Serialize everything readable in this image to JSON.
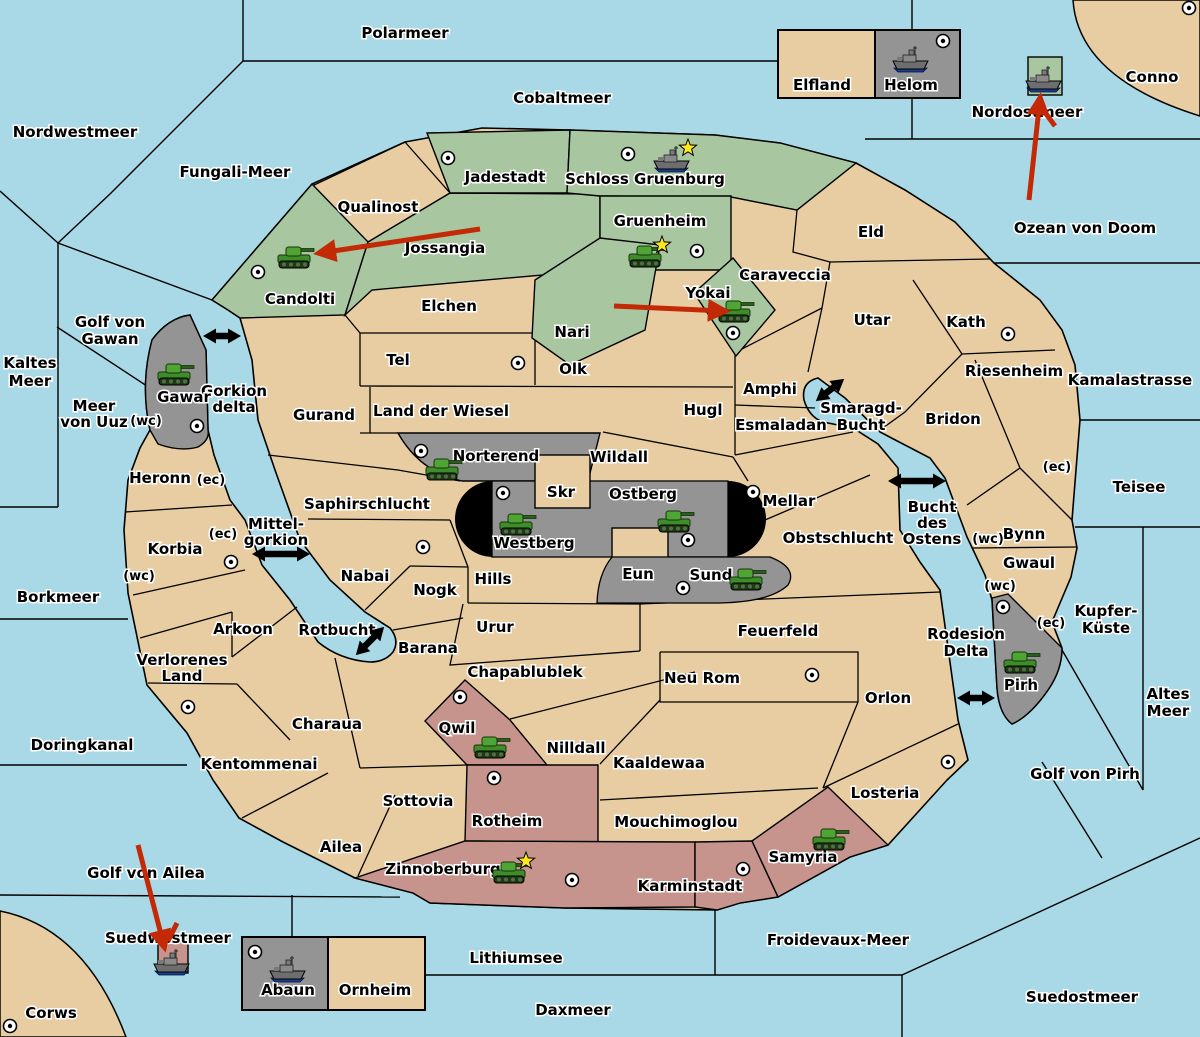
{
  "colors": {
    "sea": "#A9D9E6",
    "land": "#E9CDA2",
    "green": "#A8C6A0",
    "gray": "#949494",
    "red": "#C6948D",
    "black_zone": "#000000",
    "arrow_red": "#C32905",
    "border": "#000000",
    "star": "#FFE81E"
  },
  "ownership": {
    "green_regions": [
      "Candolti",
      "Jossangia",
      "Jadestadt",
      "Schloss Gruenburg",
      "Gruenheim",
      "Nari",
      "Yokai"
    ],
    "gray_regions": [
      "Gawar",
      "Norterend",
      "Westberg",
      "Ostberg",
      "Sund",
      "Pirh",
      "Helom",
      "Abaun"
    ],
    "red_regions": [
      "Qwil",
      "Rotheim",
      "Zinnoberburg",
      "Karminstadt",
      "Samyria"
    ]
  },
  "labels": [
    {
      "id": "polarmeer",
      "k": "sea",
      "x": 405,
      "y": 38,
      "t": "Polarmeer"
    },
    {
      "id": "cobaltmeer",
      "k": "sea",
      "x": 562,
      "y": 103,
      "t": "Cobaltmeer"
    },
    {
      "id": "nordwestmeer",
      "k": "sea",
      "x": 75,
      "y": 137,
      "t": "Nordwestmeer"
    },
    {
      "id": "fungali-meer",
      "k": "sea",
      "x": 235,
      "y": 177,
      "t": "Fungali-Meer"
    },
    {
      "id": "kaltes-meer",
      "k": "sea",
      "x": 30,
      "y": 368,
      "lines": [
        "Kaltes",
        "Meer"
      ],
      "lh": 18
    },
    {
      "id": "golf-von-gawan",
      "k": "sea",
      "x": 110,
      "y": 327,
      "lines": [
        "Golf von",
        "Gawan"
      ],
      "lh": 17
    },
    {
      "id": "meer-von-uuz",
      "k": "sea",
      "x": 94,
      "y": 411,
      "lines": [
        "Meer",
        "von Uuz"
      ],
      "lh": 16
    },
    {
      "id": "gorkion-delta",
      "k": "sea",
      "x": 234,
      "y": 396,
      "lines": [
        "Gorkion",
        "delta"
      ],
      "lh": 16
    },
    {
      "id": "mittel-gorkion",
      "k": "sea",
      "x": 276,
      "y": 529,
      "lines": [
        "Mittel-",
        "gorkion"
      ],
      "lh": 16
    },
    {
      "id": "borkmeer",
      "k": "sea",
      "x": 58,
      "y": 602,
      "t": "Borkmeer"
    },
    {
      "id": "doringkanal",
      "k": "sea",
      "x": 82,
      "y": 750,
      "t": "Doringkanal"
    },
    {
      "id": "rotbucht",
      "k": "sea",
      "x": 337,
      "y": 635,
      "t": "Rotbucht"
    },
    {
      "id": "smaragd-bucht",
      "k": "sea",
      "x": 861,
      "y": 413,
      "lines": [
        "Smaragd-",
        "Bucht"
      ],
      "lh": 17
    },
    {
      "id": "bucht-des-ostens",
      "k": "sea",
      "x": 932,
      "y": 512,
      "lines": [
        "Bucht",
        "des",
        "Ostens"
      ],
      "lh": 16
    },
    {
      "id": "rodesion-delta",
      "k": "sea",
      "x": 966,
      "y": 639,
      "lines": [
        "Rodesion",
        "Delta"
      ],
      "lh": 17
    },
    {
      "id": "golf-von-pirh",
      "k": "sea",
      "x": 1085,
      "y": 779,
      "t": "Golf von Pirh"
    },
    {
      "id": "altes-meer",
      "k": "sea",
      "x": 1168,
      "y": 699,
      "lines": [
        "Altes",
        "Meer"
      ],
      "lh": 17
    },
    {
      "id": "kupfer-kueste",
      "k": "sea",
      "x": 1106,
      "y": 616,
      "lines": [
        "Kupfer-",
        "Küste"
      ],
      "lh": 17
    },
    {
      "id": "teisee",
      "k": "sea",
      "x": 1139,
      "y": 492,
      "t": "Teisee"
    },
    {
      "id": "kamalastrasse",
      "k": "sea",
      "x": 1130,
      "y": 385,
      "t": "Kamalastrasse"
    },
    {
      "id": "ozean-von-doom",
      "k": "sea",
      "x": 1085,
      "y": 233,
      "t": "Ozean von Doom"
    },
    {
      "id": "conno",
      "k": "sea",
      "x": 1152,
      "y": 82,
      "t": "Conno"
    },
    {
      "id": "nordostmeer",
      "k": "sea",
      "x": 1027,
      "y": 117,
      "t": "Nordostmeer"
    },
    {
      "id": "froidevaux-meer",
      "k": "sea",
      "x": 838,
      "y": 945,
      "t": "Froidevaux-Meer"
    },
    {
      "id": "suedostmeer",
      "k": "sea",
      "x": 1082,
      "y": 1002,
      "t": "Suedostmeer"
    },
    {
      "id": "daxmeer",
      "k": "sea",
      "x": 573,
      "y": 1015,
      "t": "Daxmeer"
    },
    {
      "id": "lithiumsee",
      "k": "sea",
      "x": 516,
      "y": 963,
      "t": "Lithiumsee"
    },
    {
      "id": "suedwestmeer",
      "k": "sea",
      "x": 168,
      "y": 943,
      "t": "Suedwestmeer"
    },
    {
      "id": "golf-von-ailea",
      "k": "sea",
      "x": 146,
      "y": 878,
      "t": "Golf von Ailea"
    },
    {
      "id": "corws",
      "k": "sea",
      "x": 51,
      "y": 1018,
      "t": "Corws"
    },
    {
      "id": "qualinost",
      "k": "land",
      "x": 378,
      "y": 212,
      "t": "Qualinost"
    },
    {
      "id": "jadestadt",
      "k": "land",
      "x": 505,
      "y": 182,
      "t": "Jadestadt"
    },
    {
      "id": "schloss-gruenburg",
      "k": "land",
      "x": 645,
      "y": 184,
      "t": "Schloss Gruenburg"
    },
    {
      "id": "gruenheim",
      "k": "land",
      "x": 660,
      "y": 226,
      "t": "Gruenheim"
    },
    {
      "id": "jossangia",
      "k": "land",
      "x": 445,
      "y": 253,
      "t": "Jossangia"
    },
    {
      "id": "candolti",
      "k": "land",
      "x": 300,
      "y": 304,
      "t": "Candolti"
    },
    {
      "id": "nari",
      "k": "land",
      "x": 572,
      "y": 337,
      "t": "Nari"
    },
    {
      "id": "yokai",
      "k": "land",
      "x": 708,
      "y": 298,
      "t": "Yokai"
    },
    {
      "id": "elchen",
      "k": "land",
      "x": 449,
      "y": 311,
      "t": "Elchen"
    },
    {
      "id": "tel",
      "k": "land",
      "x": 398,
      "y": 365,
      "t": "Tel"
    },
    {
      "id": "olk",
      "k": "land",
      "x": 573,
      "y": 374,
      "t": "Olk"
    },
    {
      "id": "gurand",
      "k": "land",
      "x": 324,
      "y": 420,
      "t": "Gurand"
    },
    {
      "id": "land-der-wiesel",
      "k": "land",
      "x": 441,
      "y": 416,
      "t": "Land der Wiesel"
    },
    {
      "id": "hugl",
      "k": "land",
      "x": 703,
      "y": 415,
      "t": "Hugl"
    },
    {
      "id": "amphi",
      "k": "land",
      "x": 770,
      "y": 394,
      "t": "Amphi"
    },
    {
      "id": "esmaladan",
      "k": "land",
      "x": 781,
      "y": 430,
      "t": "Esmaladan"
    },
    {
      "id": "caraveccia",
      "k": "land",
      "x": 785,
      "y": 280,
      "t": "Caraveccia"
    },
    {
      "id": "eld",
      "k": "land",
      "x": 871,
      "y": 237,
      "t": "Eld"
    },
    {
      "id": "utar",
      "k": "land",
      "x": 872,
      "y": 325,
      "t": "Utar"
    },
    {
      "id": "kath",
      "k": "land",
      "x": 966,
      "y": 327,
      "t": "Kath"
    },
    {
      "id": "riesenheim",
      "k": "land",
      "x": 1014,
      "y": 376,
      "t": "Riesenheim"
    },
    {
      "id": "bridon",
      "k": "land",
      "x": 953,
      "y": 424,
      "t": "Bridon"
    },
    {
      "id": "bynn",
      "k": "land",
      "x": 1024,
      "y": 539,
      "t": "Bynn"
    },
    {
      "id": "gwaul",
      "k": "land",
      "x": 1029,
      "y": 568,
      "t": "Gwaul"
    },
    {
      "id": "wildall",
      "k": "land",
      "x": 619,
      "y": 462,
      "t": "Wildall"
    },
    {
      "id": "skr",
      "k": "land",
      "x": 561,
      "y": 497,
      "t": "Skr"
    },
    {
      "id": "eun",
      "k": "land",
      "x": 638,
      "y": 579,
      "t": "Eun"
    },
    {
      "id": "mellar",
      "k": "land",
      "x": 789,
      "y": 506,
      "t": "Mellar"
    },
    {
      "id": "obstschlucht",
      "k": "land",
      "x": 838,
      "y": 543,
      "t": "Obstschlucht"
    },
    {
      "id": "norterend",
      "k": "land",
      "x": 496,
      "y": 461,
      "t": "Norterend"
    },
    {
      "id": "westberg",
      "k": "land",
      "x": 534,
      "y": 548,
      "t": "Westberg"
    },
    {
      "id": "ostberg",
      "k": "land",
      "x": 643,
      "y": 499,
      "t": "Ostberg"
    },
    {
      "id": "sund",
      "k": "land",
      "x": 711,
      "y": 580,
      "t": "Sund"
    },
    {
      "id": "hills",
      "k": "land",
      "x": 493,
      "y": 584,
      "t": "Hills"
    },
    {
      "id": "urur",
      "k": "land",
      "x": 495,
      "y": 632,
      "t": "Urur"
    },
    {
      "id": "feuerfeld",
      "k": "land",
      "x": 778,
      "y": 636,
      "t": "Feuerfeld"
    },
    {
      "id": "saphirschlucht",
      "k": "land",
      "x": 367,
      "y": 509,
      "t": "Saphirschlucht"
    },
    {
      "id": "nabai",
      "k": "land",
      "x": 365,
      "y": 581,
      "t": "Nabai"
    },
    {
      "id": "nogk",
      "k": "land",
      "x": 435,
      "y": 595,
      "t": "Nogk"
    },
    {
      "id": "barana",
      "k": "land",
      "x": 428,
      "y": 653,
      "t": "Barana"
    },
    {
      "id": "chapablublek",
      "k": "land",
      "x": 525,
      "y": 677,
      "t": "Chapablublek"
    },
    {
      "id": "neu-rom",
      "k": "land",
      "x": 702,
      "y": 683,
      "t": "Neu Rom"
    },
    {
      "id": "kaaldewaa",
      "k": "land",
      "x": 659,
      "y": 768,
      "t": "Kaaldewaa"
    },
    {
      "id": "nilldall",
      "k": "land",
      "x": 576,
      "y": 753,
      "t": "Nilldall"
    },
    {
      "id": "heronn",
      "k": "land",
      "x": 160,
      "y": 483,
      "t": "Heronn"
    },
    {
      "id": "korbia",
      "k": "land",
      "x": 175,
      "y": 554,
      "t": "Korbia"
    },
    {
      "id": "arkoon",
      "k": "land",
      "x": 243,
      "y": 634,
      "t": "Arkoon"
    },
    {
      "id": "verlorenes-land",
      "k": "land",
      "x": 182,
      "y": 665,
      "lines": [
        "Verlorenes",
        "Land"
      ],
      "lh": 16
    },
    {
      "id": "kentommenai",
      "k": "land",
      "x": 259,
      "y": 769,
      "t": "Kentommenai"
    },
    {
      "id": "charaua",
      "k": "land",
      "x": 327,
      "y": 729,
      "t": "Charaua"
    },
    {
      "id": "sottovia",
      "k": "land",
      "x": 418,
      "y": 806,
      "t": "Sottovia"
    },
    {
      "id": "ailea",
      "k": "land",
      "x": 341,
      "y": 852,
      "t": "Ailea"
    },
    {
      "id": "qwil",
      "k": "land",
      "x": 457,
      "y": 733,
      "t": "Qwil"
    },
    {
      "id": "rotheim",
      "k": "land",
      "x": 507,
      "y": 826,
      "t": "Rotheim"
    },
    {
      "id": "zinnoberburg",
      "k": "land",
      "x": 443,
      "y": 874,
      "t": "Zinnoberburg"
    },
    {
      "id": "karminstadt",
      "k": "land",
      "x": 690,
      "y": 891,
      "t": "Karminstadt"
    },
    {
      "id": "mouchimoglou",
      "k": "land",
      "x": 676,
      "y": 827,
      "t": "Mouchimoglou"
    },
    {
      "id": "samyria",
      "k": "land",
      "x": 803,
      "y": 862,
      "t": "Samyria"
    },
    {
      "id": "losteria",
      "k": "land",
      "x": 885,
      "y": 798,
      "t": "Losteria"
    },
    {
      "id": "orlon",
      "k": "land",
      "x": 888,
      "y": 703,
      "t": "Orlon"
    },
    {
      "id": "gawar",
      "k": "land",
      "x": 184,
      "y": 402,
      "t": "Gawar"
    },
    {
      "id": "pirh",
      "k": "land",
      "x": 1021,
      "y": 690,
      "t": "Pirh"
    },
    {
      "id": "elfland",
      "k": "land",
      "x": 822,
      "y": 90,
      "t": "Elfland"
    },
    {
      "id": "helom",
      "k": "land",
      "x": 911,
      "y": 90,
      "t": "Helom"
    },
    {
      "id": "abaun",
      "k": "land",
      "x": 288,
      "y": 995,
      "t": "Abaun"
    },
    {
      "id": "ornheim",
      "k": "land",
      "x": 375,
      "y": 995,
      "t": "Ornheim"
    },
    {
      "id": "coast-wc-heronn",
      "k": "coast",
      "x": 146,
      "y": 425,
      "t": "(wc)"
    },
    {
      "id": "coast-ec-heronn",
      "k": "coast",
      "x": 211,
      "y": 484,
      "t": "(ec)"
    },
    {
      "id": "coast-ec-korbia",
      "k": "coast",
      "x": 223,
      "y": 538,
      "t": "(ec)"
    },
    {
      "id": "coast-wc-korbia",
      "k": "coast",
      "x": 139,
      "y": 580,
      "t": "(wc)"
    },
    {
      "id": "coast-wc-bynn",
      "k": "coast",
      "x": 988,
      "y": 543,
      "t": "(wc)"
    },
    {
      "id": "coast-wc-gwaul",
      "k": "coast",
      "x": 1000,
      "y": 590,
      "t": "(wc)"
    },
    {
      "id": "coast-ec-gwaul",
      "k": "coast",
      "x": 1051,
      "y": 627,
      "t": "(ec)"
    },
    {
      "id": "coast-ec-riesenheim",
      "k": "coast",
      "x": 1057,
      "y": 471,
      "t": "(ec)"
    }
  ],
  "supply_centers": [
    {
      "territory": "Candolti",
      "x": 258,
      "y": 272
    },
    {
      "territory": "Jadestadt",
      "x": 448,
      "y": 158
    },
    {
      "territory": "Schloss Gruenburg",
      "x": 628,
      "y": 154
    },
    {
      "territory": "Gruenheim",
      "x": 697,
      "y": 251
    },
    {
      "territory": "Yokai",
      "x": 733,
      "y": 333
    },
    {
      "territory": "Tel",
      "x": 518,
      "y": 363
    },
    {
      "territory": "Norterend",
      "x": 421,
      "y": 451
    },
    {
      "territory": "Westberg",
      "x": 503,
      "y": 493
    },
    {
      "territory": "Ostberg",
      "x": 688,
      "y": 540
    },
    {
      "territory": "Mellar",
      "x": 753,
      "y": 492
    },
    {
      "territory": "Sund",
      "x": 683,
      "y": 588
    },
    {
      "territory": "Gawar",
      "x": 197,
      "y": 426
    },
    {
      "territory": "Korbia",
      "x": 231,
      "y": 562
    },
    {
      "territory": "Nabai",
      "x": 423,
      "y": 547
    },
    {
      "territory": "Qwil",
      "x": 460,
      "y": 697
    },
    {
      "territory": "Rotheim",
      "x": 494,
      "y": 778
    },
    {
      "territory": "Zinnoberburg",
      "x": 572,
      "y": 880
    },
    {
      "territory": "Karminstadt",
      "x": 743,
      "y": 869
    },
    {
      "territory": "Losteria",
      "x": 948,
      "y": 762
    },
    {
      "territory": "Neu Rom",
      "x": 812,
      "y": 675
    },
    {
      "territory": "Kentommenai",
      "x": 188,
      "y": 707
    },
    {
      "territory": "Corws",
      "x": 10,
      "y": 1026
    },
    {
      "territory": "Conno",
      "x": 1189,
      "y": 8
    },
    {
      "territory": "Helom",
      "x": 943,
      "y": 41
    },
    {
      "territory": "Abaun",
      "x": 255,
      "y": 952
    },
    {
      "territory": "Pirh",
      "x": 1003,
      "y": 607
    },
    {
      "territory": "Kath",
      "x": 1008,
      "y": 334
    }
  ],
  "units": [
    {
      "type": "army",
      "territory": "Candolti",
      "x": 295,
      "y": 258,
      "star": false
    },
    {
      "type": "army",
      "territory": "Gruenheim",
      "x": 646,
      "y": 257,
      "star": true
    },
    {
      "type": "army",
      "territory": "Yokai",
      "x": 735,
      "y": 312,
      "star": false
    },
    {
      "type": "army",
      "territory": "Gawar",
      "x": 175,
      "y": 375,
      "star": false
    },
    {
      "type": "army",
      "territory": "Norterend",
      "x": 443,
      "y": 470,
      "star": false
    },
    {
      "type": "army",
      "territory": "Westberg",
      "x": 517,
      "y": 525,
      "star": false
    },
    {
      "type": "army",
      "territory": "Ostberg",
      "x": 675,
      "y": 522,
      "star": false
    },
    {
      "type": "army",
      "territory": "Sund",
      "x": 747,
      "y": 580,
      "star": false
    },
    {
      "type": "army",
      "territory": "Qwil",
      "x": 491,
      "y": 748,
      "star": false
    },
    {
      "type": "army",
      "territory": "Zinnoberburg",
      "x": 510,
      "y": 873,
      "star": true
    },
    {
      "type": "army",
      "territory": "Samyria",
      "x": 830,
      "y": 840,
      "star": false
    },
    {
      "type": "army",
      "territory": "Pirh",
      "x": 1021,
      "y": 663,
      "star": false
    },
    {
      "type": "fleet",
      "territory": "Schloss Gruenburg",
      "x": 672,
      "y": 160,
      "star": true
    },
    {
      "type": "fleet",
      "territory": "Helom",
      "x": 911,
      "y": 60,
      "star": false
    },
    {
      "type": "fleet",
      "territory": "Nordostmeer",
      "x": 1044,
      "y": 80,
      "star": false
    },
    {
      "type": "fleet",
      "territory": "Abaun",
      "x": 288,
      "y": 970,
      "star": false
    },
    {
      "type": "fleet",
      "territory": "Suedwestmeer",
      "x": 172,
      "y": 963,
      "star": false
    }
  ],
  "unit_boxes": [
    {
      "id": "nordostmeer-unit-box",
      "x": 1028,
      "y": 57,
      "w": 34,
      "h": 38,
      "color": "green"
    },
    {
      "id": "suedwestmeer-unit-box",
      "x": 158,
      "y": 942,
      "w": 30,
      "h": 31,
      "color": "red"
    }
  ],
  "move_arrows": [
    {
      "x1": 480,
      "y1": 229,
      "x2": 320,
      "y2": 253,
      "head": true
    },
    {
      "x1": 614,
      "y1": 306,
      "x2": 724,
      "y2": 311,
      "head": true
    },
    {
      "x1": 1029,
      "y1": 200,
      "x2": 1040,
      "y2": 99,
      "head": true
    },
    {
      "x1": 1055,
      "y1": 126,
      "x2": 1041,
      "y2": 107,
      "head": false
    },
    {
      "x1": 138,
      "y1": 845,
      "x2": 164,
      "y2": 946,
      "head": true
    },
    {
      "x1": 177,
      "y1": 923,
      "x2": 168,
      "y2": 941,
      "head": false
    }
  ],
  "strait_arrows": [
    {
      "id": "gorkion-delta-strait",
      "cx": 222,
      "cy": 336,
      "len": 38,
      "angle": 0
    },
    {
      "id": "mittel-gorkion-strait",
      "cx": 281,
      "cy": 554,
      "len": 58,
      "angle": 0
    },
    {
      "id": "rotbucht-strait",
      "cx": 370,
      "cy": 641,
      "len": 40,
      "angle": -45
    },
    {
      "id": "smaragd-bucht-strait",
      "cx": 830,
      "cy": 390,
      "len": 36,
      "angle": -38
    },
    {
      "id": "bucht-des-ostens-strait",
      "cx": 917,
      "cy": 481,
      "len": 58,
      "angle": 0
    },
    {
      "id": "rodesion-delta-strait",
      "cx": 976,
      "cy": 698,
      "len": 38,
      "angle": 0
    }
  ],
  "insets": [
    {
      "id": "elfland-helom-box",
      "left": "Elfland",
      "right": "Helom"
    },
    {
      "id": "abaun-ornheim-box",
      "left": "Abaun",
      "right": "Ornheim"
    }
  ]
}
